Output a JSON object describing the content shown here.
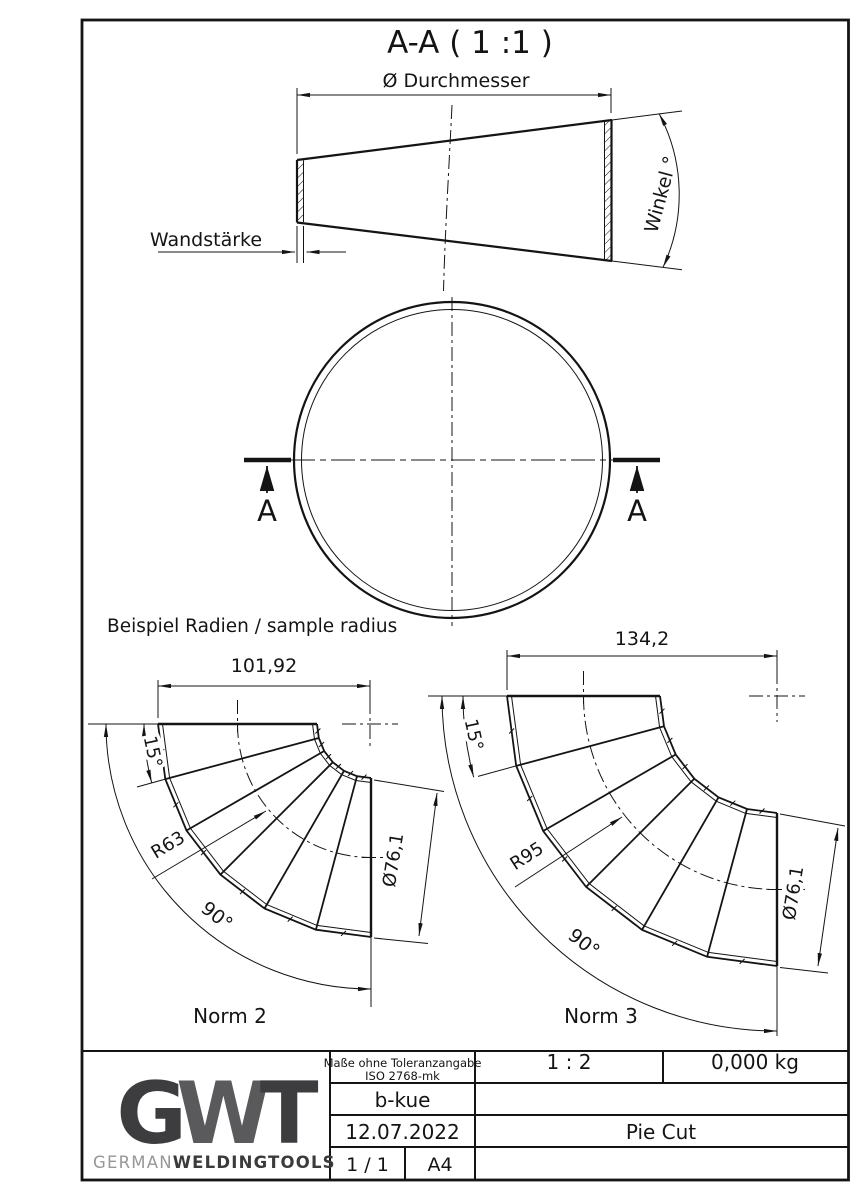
{
  "drawing": {
    "section_title": "A-A ( 1 :1 )",
    "cone": {
      "diameter_label": "Ø Durchmesser",
      "wall_label": "Wandstärke",
      "angle_label": "Winkel °"
    },
    "circle_view": {
      "section_marker_left": "A",
      "section_marker_right": "A"
    },
    "samples_heading": "Beispiel Radien / sample radius",
    "norm2": {
      "name": "Norm 2",
      "width": "101,92",
      "segment_angle": "15°",
      "radius": "R63",
      "sweep": "90°",
      "diameter": "Ø76,1"
    },
    "norm3": {
      "name": "Norm 3",
      "width": "134,2",
      "segment_angle": "15°",
      "radius": "R95",
      "sweep": "90°",
      "diameter": "Ø76,1"
    }
  },
  "title_block": {
    "tolerance_line1": "Maße ohne Toleranzangabe",
    "tolerance_line2": "ISO 2768-mk",
    "author": "b-kue",
    "date": "12.07.2022",
    "sheet": "1 / 1",
    "format": "A4",
    "scale": "1 : 2",
    "weight": "0,000 kg",
    "part_title": "Pie Cut",
    "logo": {
      "g": "G",
      "w": "W",
      "t": "T",
      "brand_light": "GERMAN",
      "brand_bold": "WELDINGTOOLS"
    },
    "colors": {
      "logo_dark": "#3d3d3f",
      "logo_mid": "#5a5a5c",
      "brand_light": "#979797",
      "brand_dark": "#3b3b3b",
      "line": "#141414"
    }
  }
}
